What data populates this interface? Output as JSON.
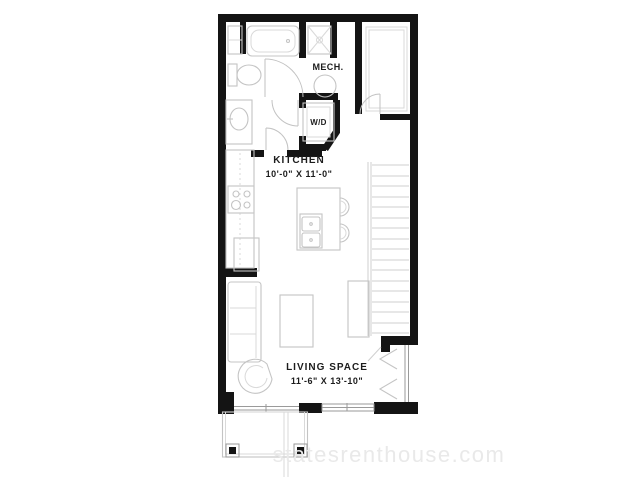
{
  "floorplan": {
    "rooms": {
      "kitchen": {
        "label": "KITCHEN",
        "dimensions": "10'-0\" X 11'-0\""
      },
      "living": {
        "label": "LIVING SPACE",
        "dimensions": "11'-6\" X 13'-10\""
      },
      "mech": {
        "label": "MECH."
      },
      "laundry": {
        "label": "W/D"
      }
    },
    "watermark": "statesrenthouse.com",
    "colors": {
      "wall": "#141414",
      "fixture_outline": "#c4c4c4",
      "stair_tread": "#cfcfcf",
      "watermark": "#e9e9e9",
      "background": "#ffffff"
    }
  }
}
